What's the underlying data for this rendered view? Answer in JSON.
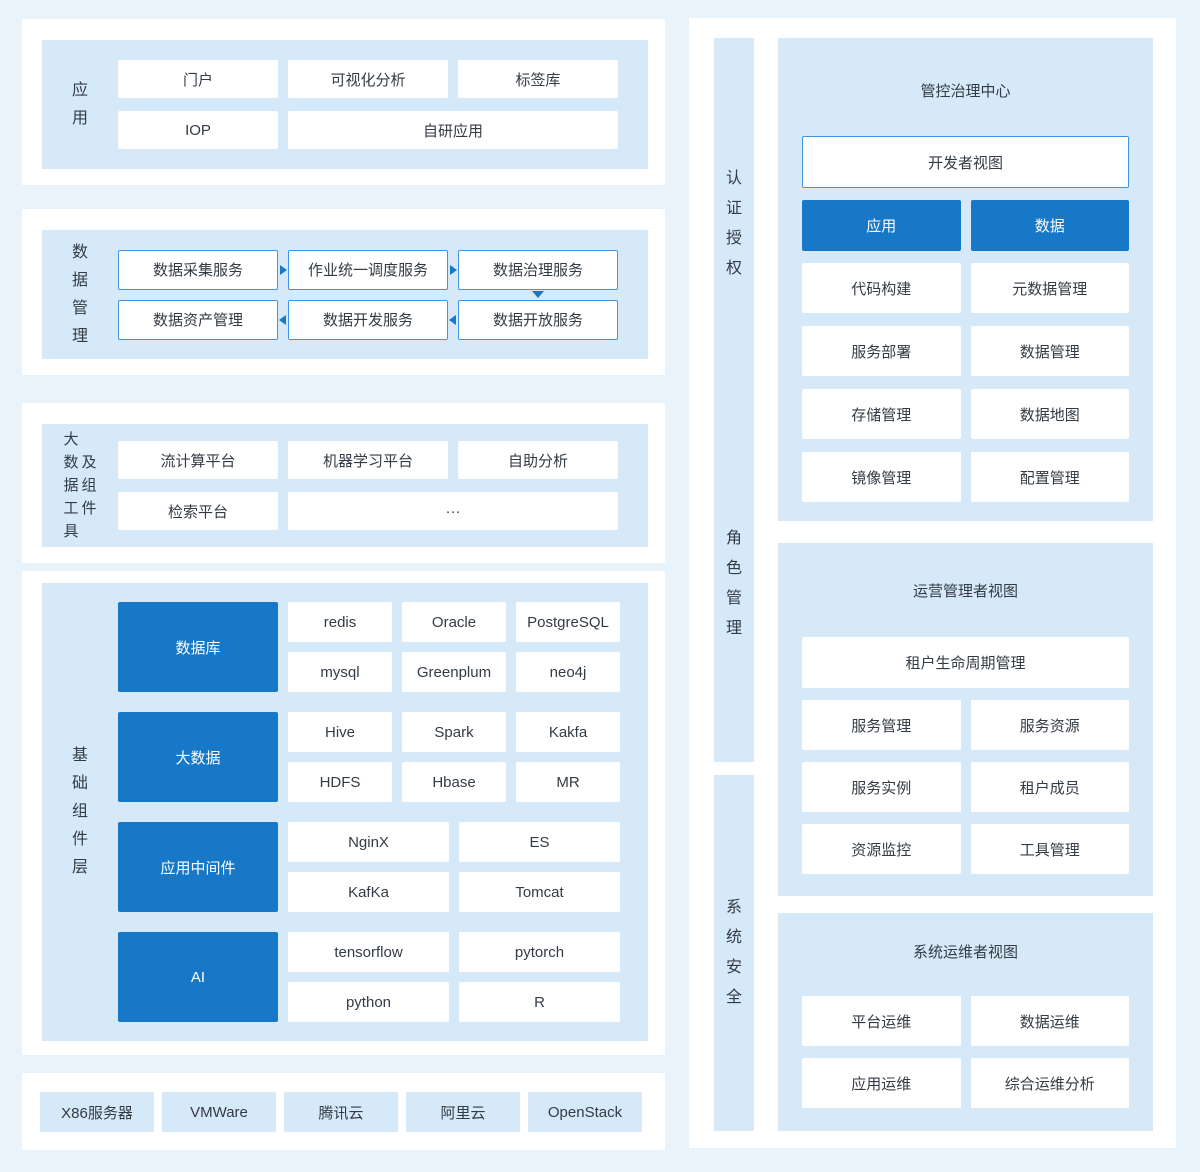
{
  "colors": {
    "page_bg": "#E9F3FC",
    "container_bg": "#FFFFFF",
    "panel_bg": "#D6E9F8",
    "accent_blue": "#1878C8",
    "outline_blue": "#3E93E2",
    "text": "#333B44",
    "inverse_text": "#FFFFFF"
  },
  "app_section": {
    "label": "应用",
    "row1": [
      "门户",
      "可视化分析",
      "标签库"
    ],
    "row2": [
      "IOP",
      "自研应用"
    ]
  },
  "data_mgmt_section": {
    "label": "数据管理",
    "row1": [
      "数据采集服务",
      "作业统一调度服务",
      "数据治理服务"
    ],
    "row2": [
      "数据资产管理",
      "数据开发服务",
      "数据开放服务"
    ]
  },
  "bigdata_tools_section": {
    "label_col1": "大数据工具",
    "label_col2": "及组件",
    "row1": [
      "流计算平台",
      "机器学习平台",
      "自助分析"
    ],
    "row2": [
      "检索平台",
      "···"
    ]
  },
  "base_layer_section": {
    "label": "基础组件层",
    "groups": [
      {
        "name": "数据库",
        "items": [
          "redis",
          "Oracle",
          "PostgreSQL",
          "mysql",
          "Greenplum",
          "neo4j"
        ]
      },
      {
        "name": "大数据",
        "items": [
          "Hive",
          "Spark",
          "Kakfa",
          "HDFS",
          "Hbase",
          "MR"
        ]
      },
      {
        "name": "应用中间件",
        "items": [
          "NginX",
          "ES",
          "KafKa",
          "Tomcat"
        ]
      },
      {
        "name": "AI",
        "items": [
          "tensorflow",
          "pytorch",
          "python",
          "R"
        ]
      }
    ]
  },
  "infra_section": {
    "items": [
      "X86服务器",
      "VMWare",
      "腾讯云",
      "阿里云",
      "OpenStack"
    ]
  },
  "right": {
    "bars": [
      "认证授权",
      "角色管理",
      "系统安全"
    ],
    "panel1": {
      "title": "管控治理中心",
      "view": "开发者视图",
      "tabs": [
        "应用",
        "数据"
      ],
      "cells": [
        "代码构建",
        "元数据管理",
        "服务部署",
        "数据管理",
        "存储管理",
        "数据地图",
        "镜像管理",
        "配置管理"
      ]
    },
    "panel2": {
      "title": "运营管理者视图",
      "full": "租户生命周期管理",
      "cells": [
        "服务管理",
        "服务资源",
        "服务实例",
        "租户成员",
        "资源监控",
        "工具管理"
      ]
    },
    "panel3": {
      "title": "系统运维者视图",
      "cells": [
        "平台运维",
        "数据运维",
        "应用运维",
        "综合运维分析"
      ]
    }
  }
}
